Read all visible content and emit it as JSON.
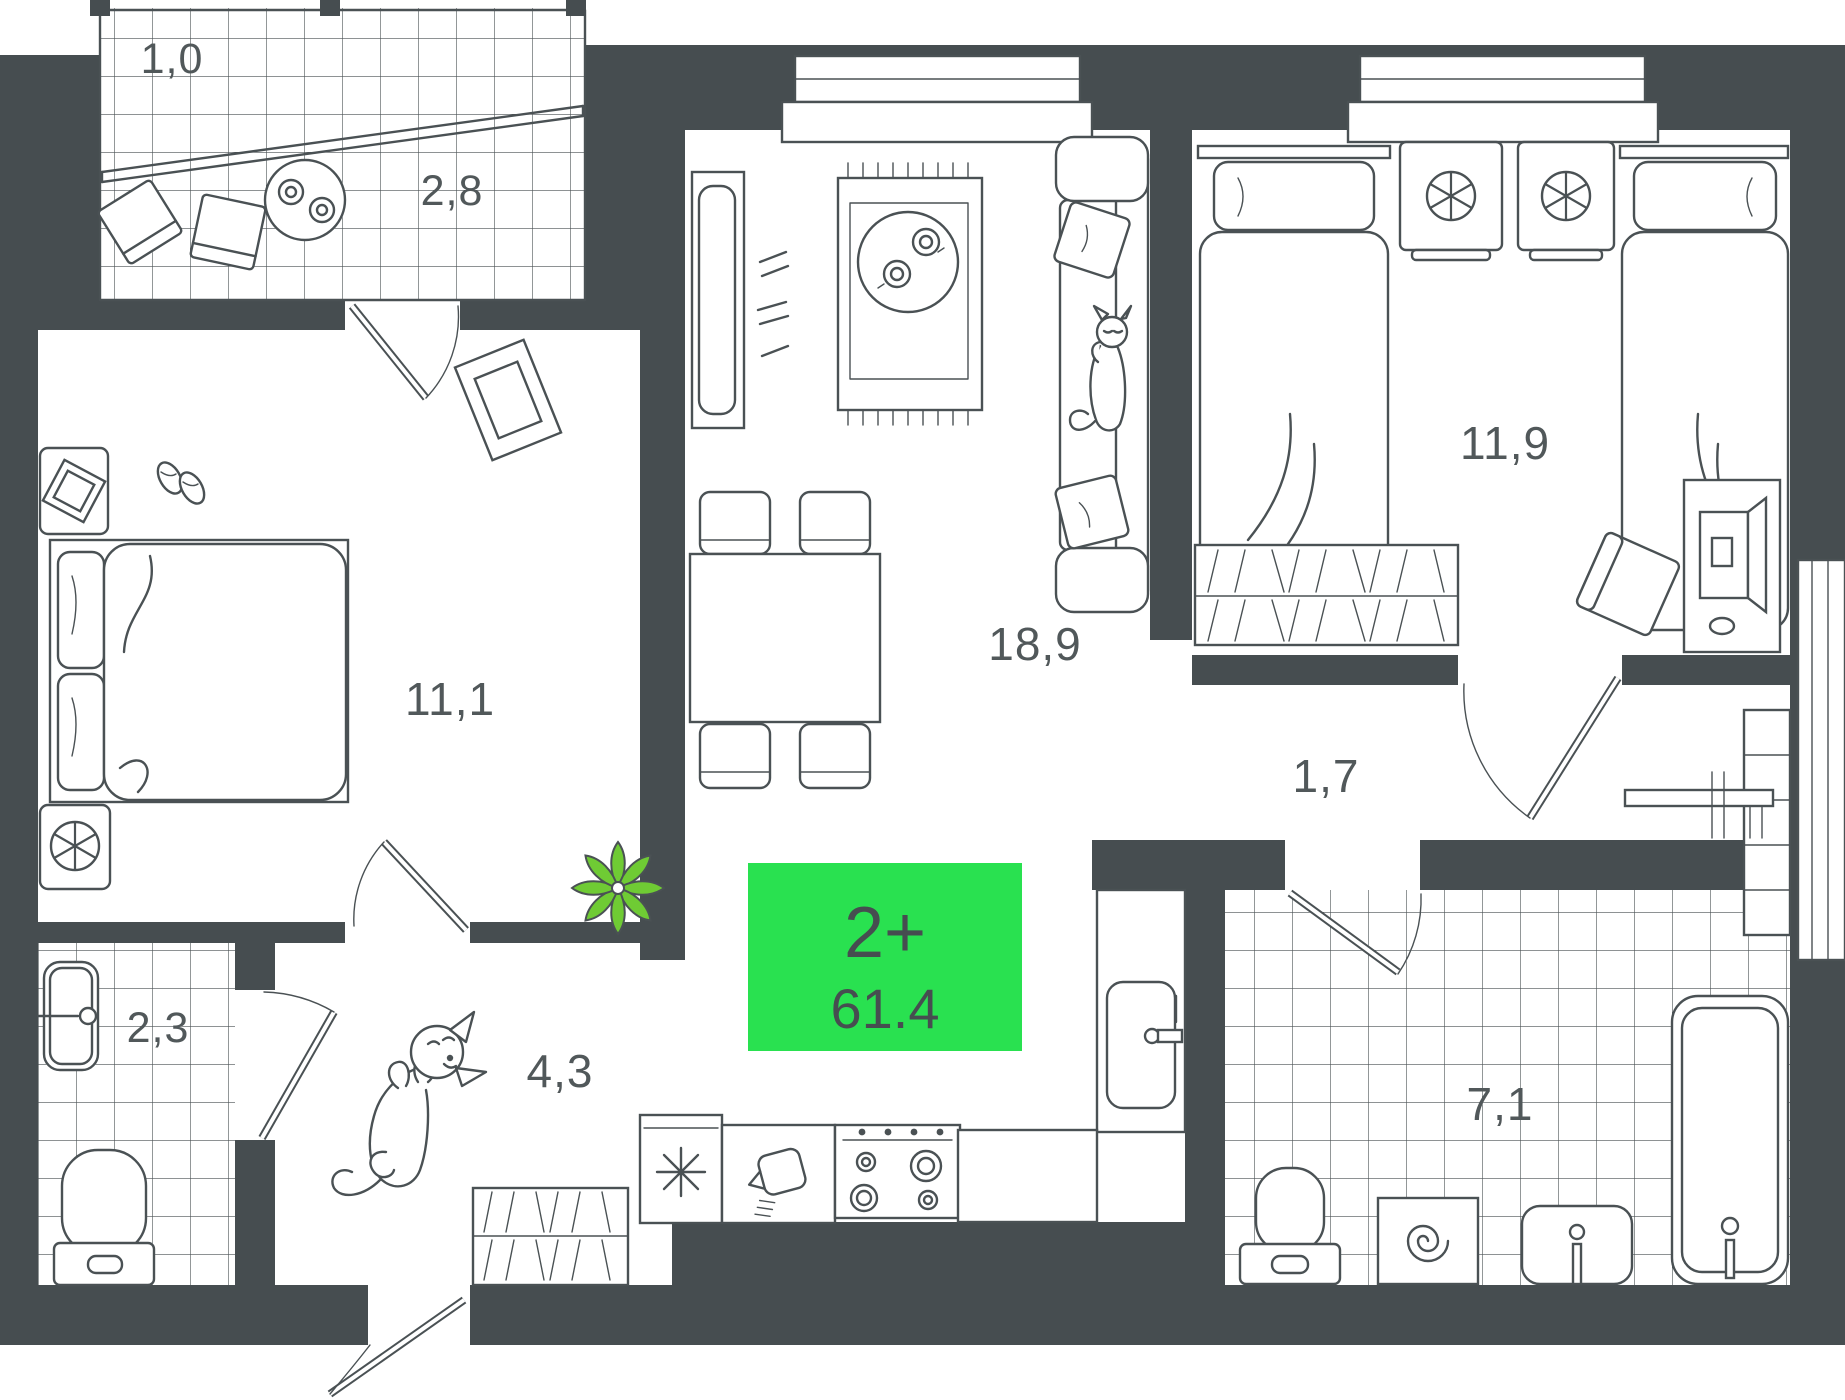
{
  "floor_plan": {
    "badge": {
      "label": "2+",
      "area": "61.4"
    },
    "rooms": {
      "balcony_small": "1,0",
      "balcony": "2,8",
      "bedroom_left": "11,1",
      "living_room": "18,9",
      "bedroom_right": "11,9",
      "hall": "1,7",
      "bathroom_small": "2,3",
      "corridor": "4,3",
      "bathroom": "7,1"
    },
    "colors": {
      "wall": "#464D50",
      "line": "#4A5154",
      "background": "#FFFFFF",
      "badge_green": "#29E150",
      "badge_text": "#464D50",
      "label_text": "#51585A",
      "plant_green": "#6FCB34"
    }
  }
}
